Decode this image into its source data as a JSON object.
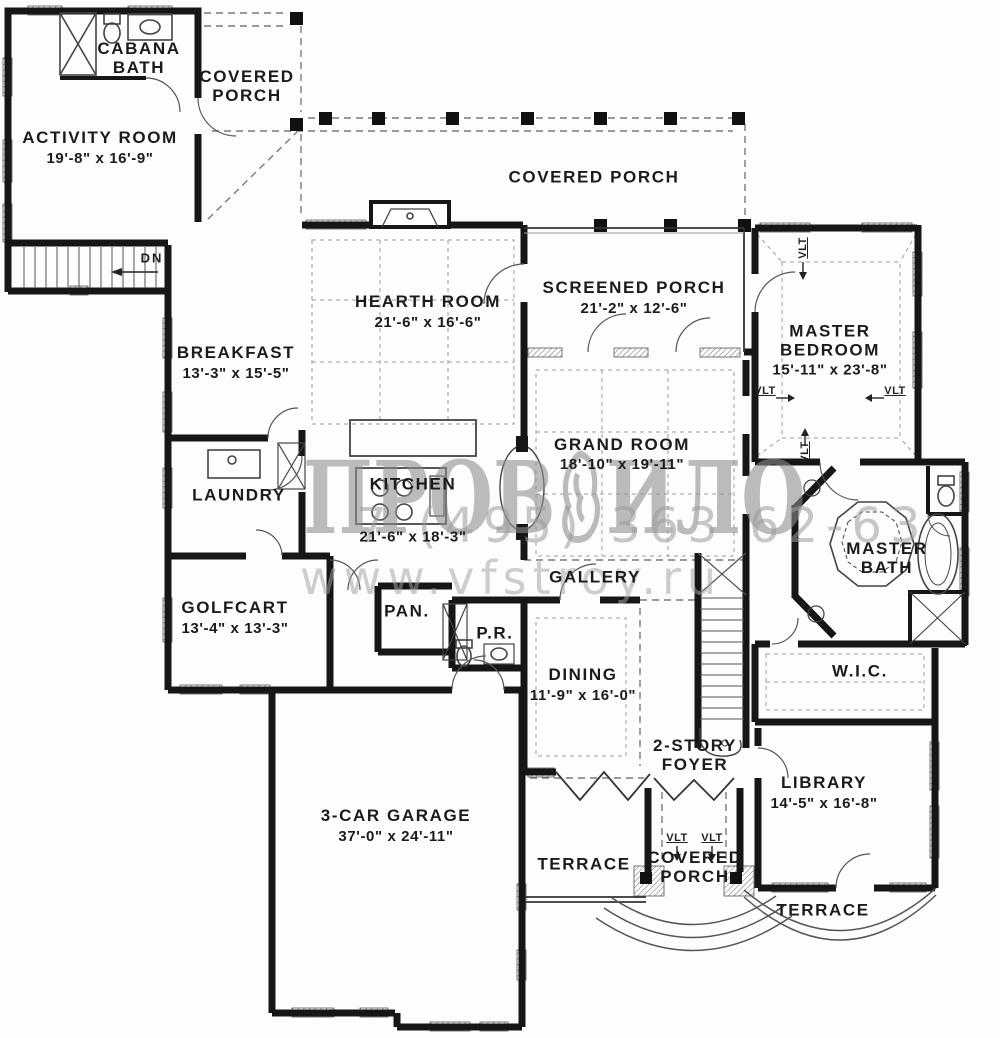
{
  "watermark": {
    "logo_left": "ПРОВ",
    "logo_right": "ИЛО",
    "phone": "7 (495) 363 62-63",
    "website": "www.vfstroy.ru"
  },
  "labels": {
    "vlt": "VLT",
    "dn": "DN"
  },
  "rooms": {
    "cabana_bath": {
      "line1": "CABANA",
      "line2": "BATH"
    },
    "covered_porch_nw": {
      "line1": "COVERED",
      "line2": "PORCH"
    },
    "activity_room": {
      "name": "ACTIVITY ROOM",
      "dims": "19'-8\" x 16'-9\""
    },
    "covered_porch_top": {
      "name": "COVERED PORCH"
    },
    "hearth_room": {
      "name": "HEARTH ROOM",
      "dims": "21'-6\" x 16'-6\""
    },
    "screened_porch": {
      "name": "SCREENED PORCH",
      "dims": "21'-2\" x 12'-6\""
    },
    "master_bedroom": {
      "line1": "MASTER",
      "line2": "BEDROOM",
      "dims": "15'-11\" x 23'-8\""
    },
    "breakfast": {
      "name": "BREAKFAST",
      "dims": "13'-3\" x 15'-5\""
    },
    "grand_room": {
      "name": "GRAND ROOM",
      "dims": "18'-10\" x 19'-11\""
    },
    "kitchen": {
      "name": "KITCHEN",
      "dims": "21'-6\" x 18'-3\""
    },
    "laundry": {
      "name": "LAUNDRY"
    },
    "master_bath": {
      "line1": "MASTER",
      "line2": "BATH"
    },
    "gallery": {
      "name": "GALLERY"
    },
    "golfcart": {
      "name": "GOLFCART",
      "dims": "13'-4\" x 13'-3\""
    },
    "pantry": {
      "name": "PAN."
    },
    "powder_room": {
      "name": "P.R."
    },
    "dining": {
      "name": "DINING",
      "dims": "11'-9\" x 16'-0\""
    },
    "wic": {
      "name": "W.I.C."
    },
    "foyer": {
      "line1": "2-STORY",
      "line2": "FOYER"
    },
    "library": {
      "name": "LIBRARY",
      "dims": "14'-5\" x 16'-8\""
    },
    "garage": {
      "name": "3-CAR GARAGE",
      "dims": "37'-0\" x 24'-11\""
    },
    "terrace_left": {
      "name": "TERRACE"
    },
    "covered_porch_s": {
      "line1": "COVERED",
      "line2": "PORCH"
    },
    "terrace_se": {
      "name": "TERRACE"
    }
  }
}
